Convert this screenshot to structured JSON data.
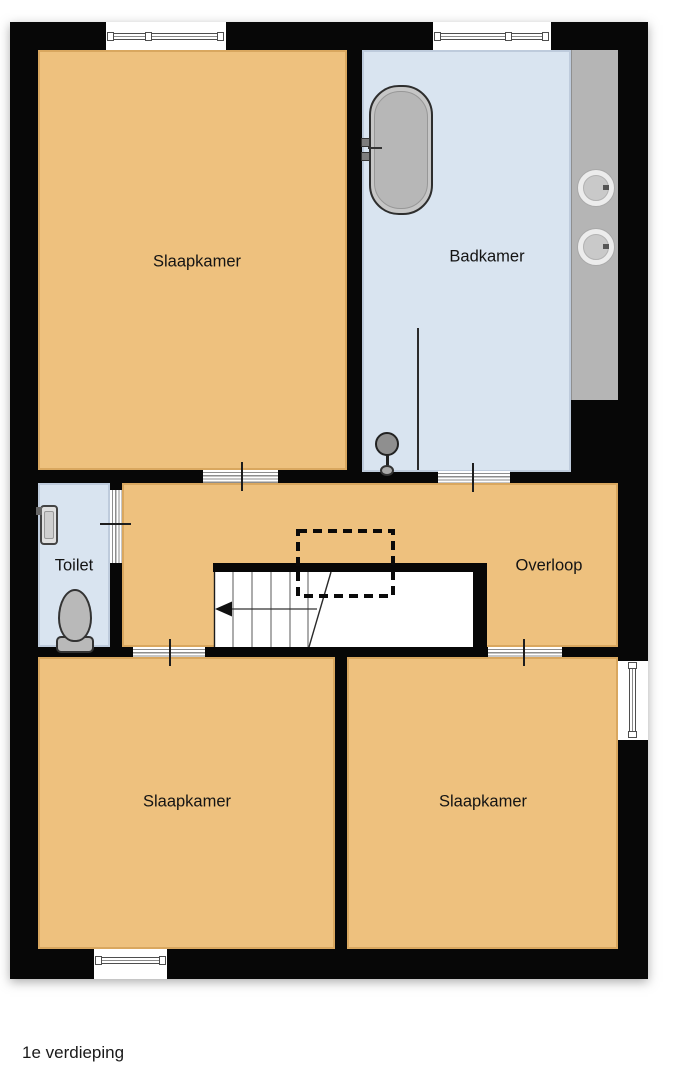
{
  "plan": {
    "floor_caption": "1e verdieping",
    "rooms": [
      {
        "id": "slaapkamer-top",
        "label": "Slaapkamer",
        "fill": "#eec17e"
      },
      {
        "id": "badkamer",
        "label": "Badkamer",
        "fill": "#d9e4f0"
      },
      {
        "id": "toilet",
        "label": "Toilet",
        "fill": "#d9e4f0"
      },
      {
        "id": "overloop",
        "label": "Overloop",
        "fill": "#eec17e"
      },
      {
        "id": "slaapkamer-bottom-left",
        "label": "Slaapkamer",
        "fill": "#eec17e"
      },
      {
        "id": "slaapkamer-bottom-right",
        "label": "Slaapkamer",
        "fill": "#eec17e"
      }
    ],
    "fixtures": [
      "bathtub-icon",
      "shower-head-icon",
      "shower-screen",
      "washbasin-icon",
      "washbasin-icon",
      "hand-basin-icon",
      "toilet-icon",
      "staircase-icon",
      "stairs-direction-arrow-icon",
      "void-dashed-outline"
    ],
    "colors": {
      "wall": "#070707",
      "room_orange": "#eec17e",
      "room_blue": "#d9e4f0",
      "counter_gray": "#b5b5b5",
      "fixture_gray": "#bcbcbc",
      "background": "#ffffff"
    }
  }
}
